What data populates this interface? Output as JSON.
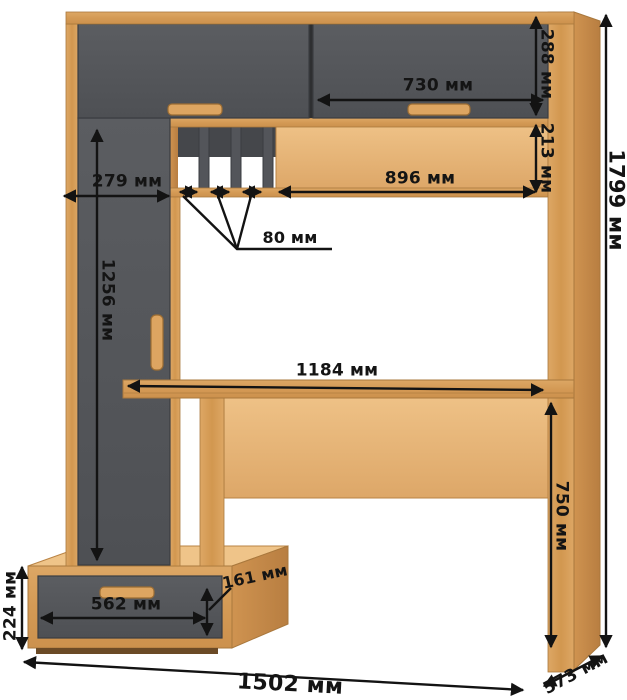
{
  "diagram_type": "furniture dimensioned drawing (desk with hutch)",
  "units_label": "мм",
  "dims": {
    "top_door_height": {
      "label": "288 мм",
      "value": 288,
      "measures": "upper cabinet door height"
    },
    "top_right_door_width": {
      "label": "730 мм",
      "value": 730,
      "measures": "upper right door width"
    },
    "shelf_niche_height": {
      "label": "213 мм",
      "value": 213,
      "measures": "open shelf niche height"
    },
    "shelf_niche_width": {
      "label": "896 мм",
      "value": 896,
      "measures": "open shelf niche width"
    },
    "left_cabinet_width": {
      "label": "279 мм",
      "value": 279,
      "measures": "tall cabinet width"
    },
    "slot_width": {
      "label": "80 мм",
      "value": 80,
      "measures": "divider slot width"
    },
    "left_door_height": {
      "label": "1256 мм",
      "value": 1256,
      "measures": "tall cabinet door height"
    },
    "desktop_width": {
      "label": "1184 мм",
      "value": 1184,
      "measures": "desktop width"
    },
    "desk_height": {
      "label": "750 мм",
      "value": 750,
      "measures": "desktop height from floor"
    },
    "total_height": {
      "label": "1799 мм",
      "value": 1799,
      "measures": "overall height"
    },
    "drawer_front_height": {
      "label": "161 мм",
      "value": 161,
      "measures": "drawer front height"
    },
    "drawer_width": {
      "label": "562 мм",
      "value": 562,
      "measures": "drawer width"
    },
    "pedestal_height": {
      "label": "224 мм",
      "value": 224,
      "measures": "pedestal height"
    },
    "total_width": {
      "label": "1502 мм",
      "value": 1502,
      "measures": "overall width"
    },
    "total_depth": {
      "label": "573 мм",
      "value": 573,
      "measures": "overall depth"
    }
  },
  "colors": {
    "wood": "#d79f5c",
    "wood_light": "#e8ba7e",
    "wood_side": "#c18344",
    "front_dark": "#55575b",
    "slot_shadow": "#45474b",
    "dimension_ink": "#131313",
    "background": "#ffffff"
  }
}
